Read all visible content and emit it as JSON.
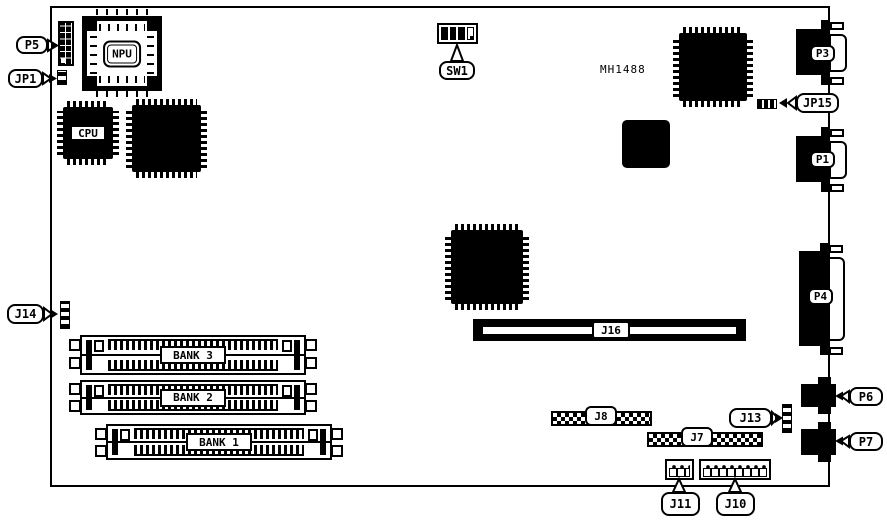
{
  "colors": {
    "ink": "#000000",
    "paper": "#ffffff"
  },
  "labels": {
    "p5": "P5",
    "jp1": "JP1",
    "npu": "NPU",
    "cpu": "CPU",
    "sw1": "SW1",
    "mh1488": "MH1488",
    "jp15": "JP15",
    "p3": "P3",
    "p1": "P1",
    "p4": "P4",
    "j14": "J14",
    "j16": "J16",
    "bank3": "BANK 3",
    "bank2": "BANK 2",
    "bank1": "BANK 1",
    "j8": "J8",
    "j7": "J7",
    "j13": "J13",
    "p6": "P6",
    "p7": "P7",
    "j11": "J11",
    "j10": "J10"
  }
}
